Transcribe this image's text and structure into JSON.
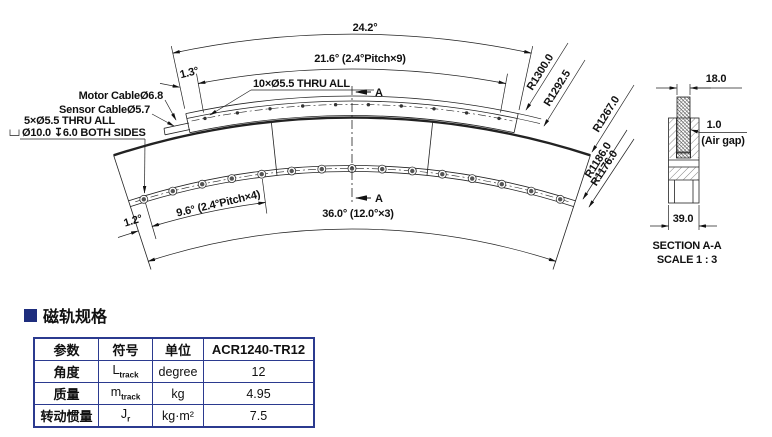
{
  "drawing": {
    "dims": {
      "top_total": "24.2°",
      "top_pitch": "21.6° (2.4°Pitch×9)",
      "top_offset": "1.3°",
      "top_holes": "10×Ø5.5 THRU ALL",
      "motor_cable": "Motor CableØ6.8",
      "sensor_cable": "Sensor CableØ5.7",
      "bottom_holes_line1": "5×Ø5.5  THRU ALL",
      "bottom_holes_line2": "Ø10.0 ↧6.0 BOTH SIDES",
      "bottom_pitch": "9.6° (2.4°Pitch×4)",
      "bottom_offset": "1.2°",
      "bottom_total": "36.0° (12.0°×3)"
    },
    "radii": [
      "R1300.0",
      "R1292.5",
      "R1267.0",
      "R1186.0",
      "R1176.0"
    ],
    "section_marker": "A",
    "section": {
      "width_top": "18.0",
      "air_gap_value": "1.0",
      "air_gap_label": "(Air gap)",
      "width_bottom": "39.0",
      "title": "SECTION A-A",
      "scale": "SCALE 1 : 3"
    }
  },
  "spec": {
    "title": "磁轨规格",
    "accent_color": "#1e2d7d",
    "table": {
      "headers": [
        "参数",
        "符号",
        "单位",
        "ACR1240-TR12"
      ],
      "rows": [
        {
          "param": "角度",
          "symbol_base": "L",
          "symbol_sub": "track",
          "unit": "degree",
          "value": "12"
        },
        {
          "param": "质量",
          "symbol_base": "m",
          "symbol_sub": "track",
          "unit": "kg",
          "value": "4.95"
        },
        {
          "param": "转动惯量",
          "symbol_base": "J",
          "symbol_sub": "r",
          "unit": "kg·m²",
          "value": "7.5"
        }
      ]
    }
  }
}
